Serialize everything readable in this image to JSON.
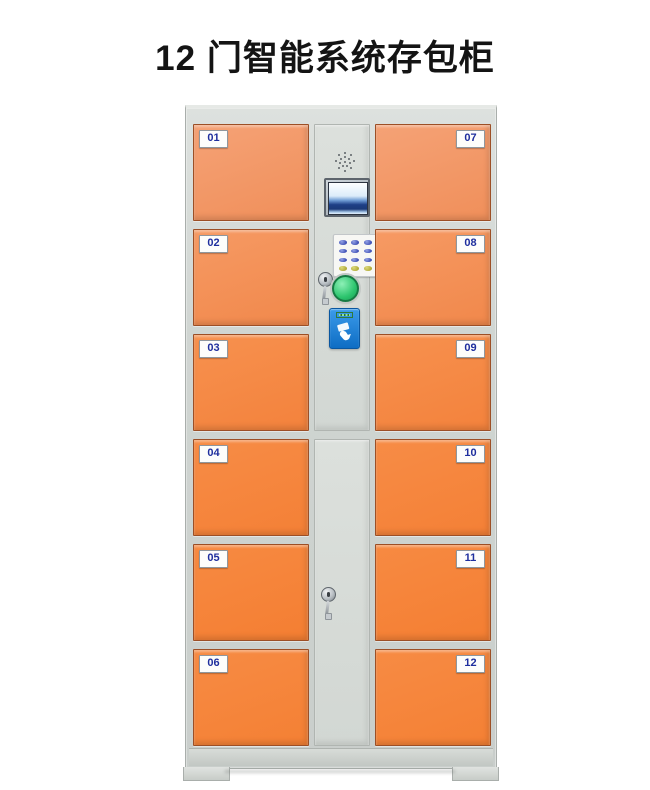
{
  "page": {
    "title": "12 门智能系统存包柜"
  },
  "cabinet": {
    "description": "12-door smart locker cabinet, orange doors on gray body",
    "left_doors": [
      {
        "number": "01"
      },
      {
        "number": "02"
      },
      {
        "number": "03"
      },
      {
        "number": "04"
      },
      {
        "number": "05"
      },
      {
        "number": "06"
      }
    ],
    "right_doors": [
      {
        "number": "07"
      },
      {
        "number": "08"
      },
      {
        "number": "09"
      },
      {
        "number": "10"
      },
      {
        "number": "11"
      },
      {
        "number": "12"
      }
    ],
    "control_panel": {
      "components": [
        "speaker-grille",
        "lcd-display",
        "numeric-keypad",
        "key-lock",
        "confirm-button",
        "card-reader"
      ],
      "keypad_keys": 12
    },
    "service_door": {
      "components": [
        "key-lock"
      ]
    }
  },
  "icons": {
    "speaker": "dot-matrix-grille",
    "card_reader": "hand-swiping-card",
    "lock": "key-cylinder-with-hanging-key"
  },
  "theme": {
    "title_color": "#141414",
    "door_orange": "#f4853c",
    "door_orange_light": "#f5a276",
    "door_border": "#9c4f26",
    "frame_gray": "#cfd4d1",
    "label_blue": "#1f2f9e",
    "reader_blue": "#0e6dc4",
    "button_green": "#2dc56e",
    "keypad_blue": "#4253b6",
    "keypad_yellow": "#b3ad3b"
  }
}
